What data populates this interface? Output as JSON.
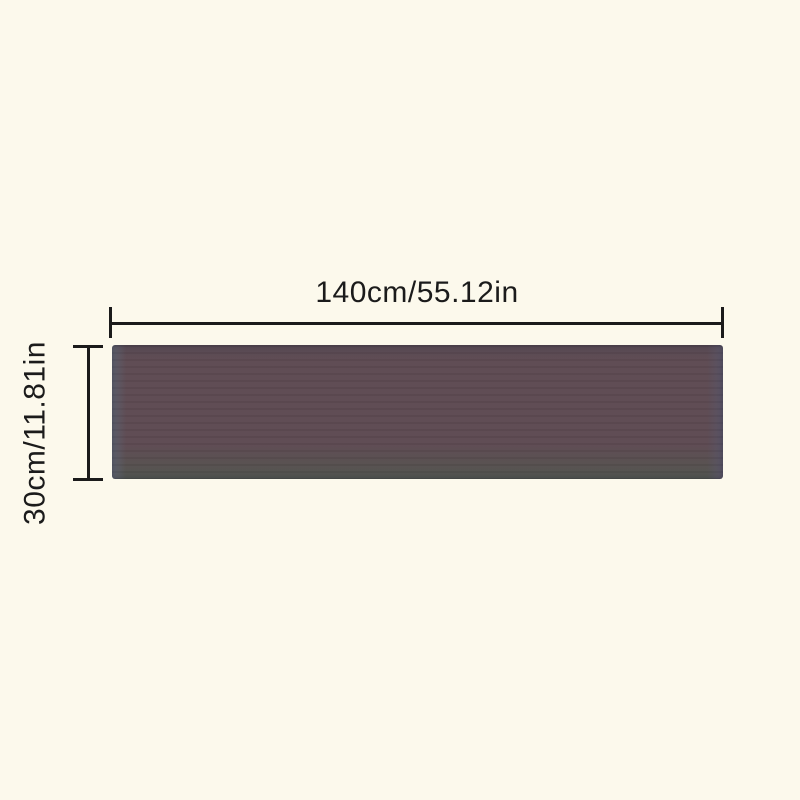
{
  "page": {
    "background_color": "#fcf9ec"
  },
  "diagram": {
    "width_dimension": {
      "label": "140cm/55.12in"
    },
    "height_dimension": {
      "label": "30cm/11.81in"
    },
    "colors": {
      "line_and_text": "#1b1b1b",
      "product_body": "#5d4a52",
      "product_edge_left": "#5a5e6b",
      "product_edge_right": "#575264",
      "product_edge_top": "#544751",
      "product_edge_bottom": "#4e524d"
    }
  }
}
